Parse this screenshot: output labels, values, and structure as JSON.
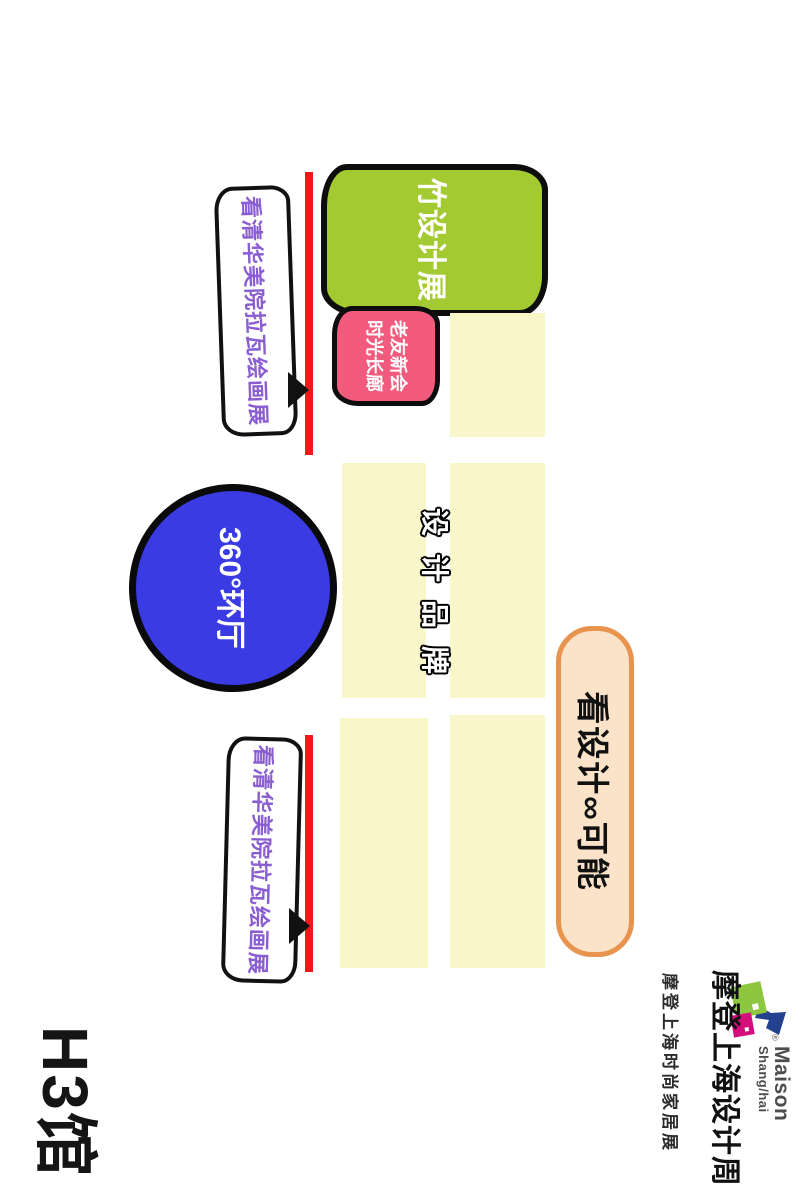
{
  "hall": {
    "label": "H3馆"
  },
  "areas": {
    "bamboo_exhibition": "竹设计展",
    "old_friends_line1": "老友新会",
    "old_friends_line2": "时光长廊",
    "gallery_banner": "看清华美院拉瓦绘画展",
    "round_hall": "360°环厅",
    "design_brands": "设计品牌",
    "design_possibility": "看设计∞可能"
  },
  "logo": {
    "maison": "Maison",
    "shanghai": "Shang/hai",
    "registered": "®",
    "title_cn": "摩登上海设计周",
    "subtitle_cn": "摩登上海时尚家居展"
  },
  "colors": {
    "bamboo_green": "#a4ca31",
    "old_friends_pink": "#f25b7d",
    "booth_yellow": "#f9f7ca",
    "round_hall_blue": "#3b3be4",
    "pill_fill": "#fbe3ca",
    "pill_border": "#e8934e",
    "wall_red": "#ee1a1a",
    "banner_text_purple": "#8a5ed1",
    "logo_green": "#8dc63f",
    "logo_magenta": "#d40f7d",
    "logo_blue": "#24418f"
  }
}
